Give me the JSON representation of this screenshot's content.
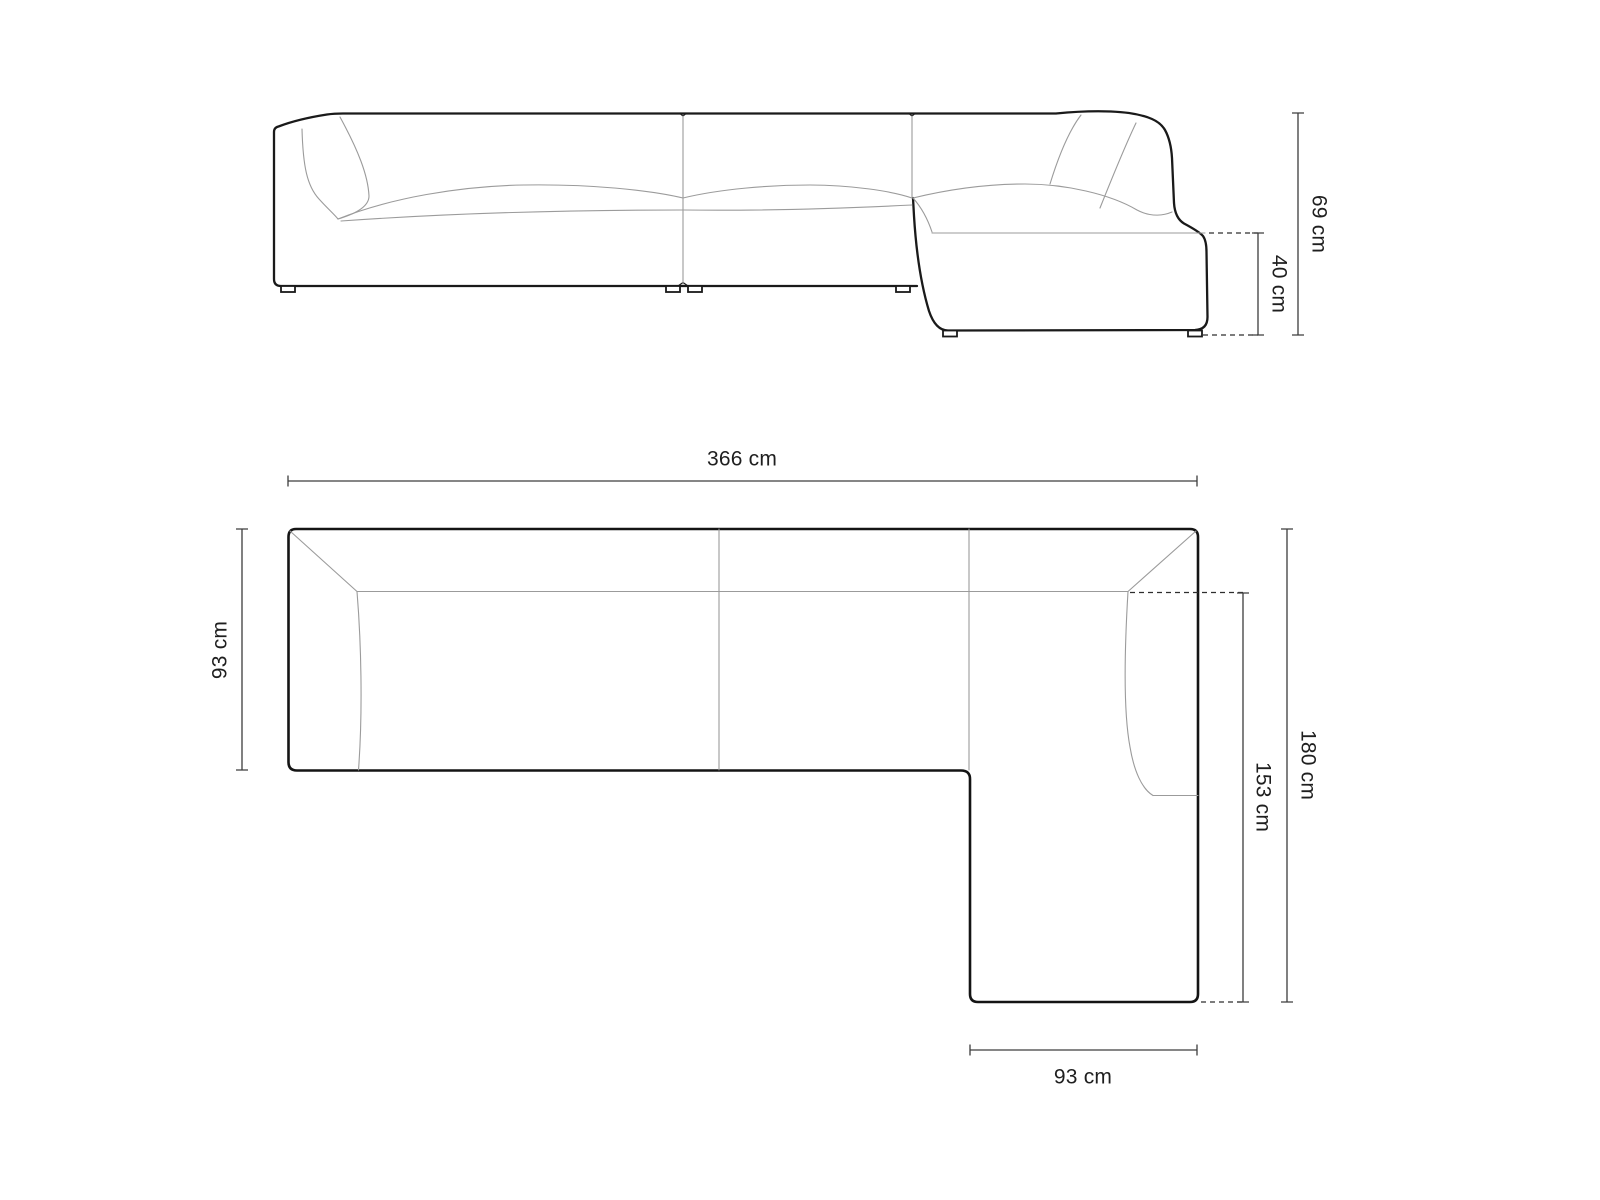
{
  "drawing": {
    "type": "corner-sofa-dimension-diagram",
    "unit": "cm"
  },
  "colors": {
    "background": "#ffffff",
    "outline": "#1a1a1a",
    "seam": "#9b9b9b",
    "dimension": "#3d3d3d",
    "text": "#1f1f1f"
  },
  "front_view": {
    "dim_height": "69 cm",
    "dim_seat_height": "40 cm"
  },
  "top_view": {
    "dim_width": "366 cm",
    "dim_depth": "93 cm",
    "dim_right_length": "180 cm",
    "dim_chaise_length": "153 cm",
    "dim_chaise_width": "93 cm"
  }
}
